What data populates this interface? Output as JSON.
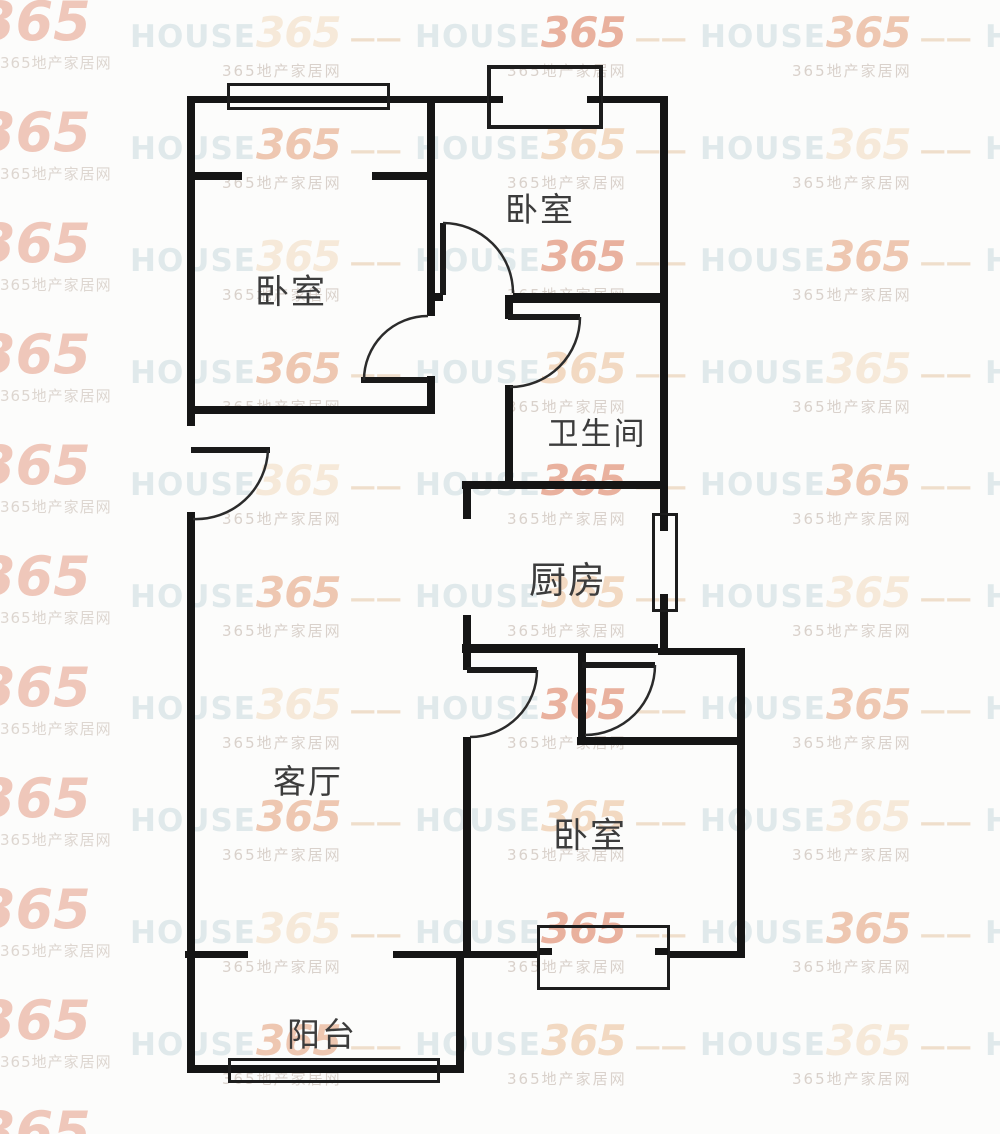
{
  "watermark": {
    "brand": "HOUSE",
    "number": "365",
    "dash": "—",
    "subtext": "365地产家居网",
    "colors": {
      "house": "#dde8ea",
      "number_palette": [
        "#f6e8d6",
        "#f1d6bc",
        "#edc2a9",
        "#e8a995"
      ],
      "big_number": "#e8a48f",
      "subtext": "#d6cdc6",
      "dash": "#eedbc6"
    },
    "grid": {
      "col_x": [
        130,
        415,
        700,
        985
      ],
      "row_start": 8,
      "row_step": 112,
      "rows": 10
    },
    "left_column": {
      "x": -22,
      "y_start": -10,
      "y_step": 111,
      "count": 11
    }
  },
  "floorplan": {
    "wall_color": "#151515",
    "arc_color": "#2b2b2b",
    "rooms": [
      {
        "id": "bedroom-top-left",
        "label": "卧室",
        "cx": 291,
        "cy": 289,
        "size": 34
      },
      {
        "id": "bedroom-top-right",
        "label": "卧室",
        "cx": 540,
        "cy": 207,
        "size": 33
      },
      {
        "id": "bathroom",
        "label": "卫生间",
        "cx": 597,
        "cy": 431,
        "size": 31
      },
      {
        "id": "kitchen",
        "label": "厨房",
        "cx": 568,
        "cy": 577,
        "size": 37
      },
      {
        "id": "living-room",
        "label": "客厅",
        "cx": 308,
        "cy": 779,
        "size": 33
      },
      {
        "id": "bedroom-bottom",
        "label": "卧室",
        "cx": 590,
        "cy": 833,
        "size": 35
      },
      {
        "id": "balcony",
        "label": "阳台",
        "cx": 322,
        "cy": 1032,
        "size": 33
      }
    ],
    "walls": [
      [
        190,
        96,
        298,
        7
      ],
      [
        602,
        96,
        65,
        7
      ],
      [
        187,
        96,
        8,
        330
      ],
      [
        187,
        512,
        8,
        561
      ],
      [
        427,
        96,
        8,
        220
      ],
      [
        427,
        376,
        8,
        38
      ],
      [
        660,
        96,
        8,
        419
      ],
      [
        660,
        610,
        8,
        42
      ],
      [
        188,
        172,
        54,
        8
      ],
      [
        372,
        172,
        58,
        8
      ],
      [
        190,
        406,
        240,
        8
      ],
      [
        427,
        293,
        16,
        8
      ],
      [
        513,
        293,
        154,
        8
      ],
      [
        505,
        295,
        163,
        8
      ],
      [
        505,
        295,
        8,
        24
      ],
      [
        505,
        385,
        8,
        104
      ],
      [
        462,
        481,
        206,
        8
      ],
      [
        463,
        481,
        8,
        38
      ],
      [
        463,
        615,
        8,
        55
      ],
      [
        463,
        737,
        8,
        221
      ],
      [
        462,
        644,
        196,
        9
      ],
      [
        658,
        648,
        86,
        7
      ],
      [
        578,
        653,
        8,
        92
      ],
      [
        577,
        737,
        167,
        8
      ],
      [
        737,
        648,
        8,
        310
      ],
      [
        393,
        951,
        144,
        7
      ],
      [
        668,
        951,
        76,
        7
      ],
      [
        185,
        951,
        63,
        7
      ],
      [
        456,
        951,
        8,
        122
      ],
      [
        187,
        1065,
        276,
        8
      ]
    ],
    "doors": [
      {
        "id": "door-bedroom-top-left",
        "panel": [
          361,
          377,
          67,
          6
        ],
        "arc": "M364,380 A64,64 0 0 1 428,316"
      },
      {
        "id": "door-bedroom-top-right",
        "panel": [
          440,
          223,
          6,
          72
        ],
        "arc": "M443,223 A70,70 0 0 1 513,293"
      },
      {
        "id": "door-bathroom",
        "panel": [
          508,
          314,
          72,
          6
        ],
        "arc": "M580,317 A70,70 0 0 1 510,387"
      },
      {
        "id": "door-entry",
        "panel": [
          191,
          447,
          79,
          6
        ],
        "arc": "M268,450 A72,72 0 0 1 193,519"
      },
      {
        "id": "door-bedroom-bottom-a",
        "panel": [
          467,
          667,
          70,
          6
        ],
        "arc": "M537,670 A67,67 0 0 1 470,737"
      },
      {
        "id": "door-bedroom-bottom-b",
        "panel": [
          582,
          662,
          73,
          6
        ],
        "arc": "M655,665 A70,70 0 0 1 585,735"
      }
    ],
    "windows": [
      {
        "id": "window-bedroom-top-left",
        "box": [
          227,
          83,
          163,
          27
        ],
        "thick": false,
        "ticks": []
      },
      {
        "id": "bay-window-top-right",
        "box": [
          487,
          65,
          116,
          64
        ],
        "thick": true,
        "ticks": [
          [
            489,
            96,
            14,
            7
          ],
          [
            587,
            96,
            14,
            7
          ]
        ]
      },
      {
        "id": "window-kitchen",
        "box": [
          652,
          513,
          26,
          99
        ],
        "thick": false,
        "ticks": [
          [
            660,
            515,
            8,
            16
          ],
          [
            660,
            594,
            8,
            16
          ]
        ]
      },
      {
        "id": "bay-window-bedroom-bottom",
        "box": [
          537,
          925,
          133,
          65
        ],
        "thick": false,
        "ticks": [
          [
            539,
            948,
            13,
            7
          ],
          [
            655,
            948,
            13,
            7
          ]
        ]
      },
      {
        "id": "window-balcony",
        "box": [
          228,
          1058,
          212,
          25
        ],
        "thick": false,
        "ticks": []
      }
    ]
  }
}
